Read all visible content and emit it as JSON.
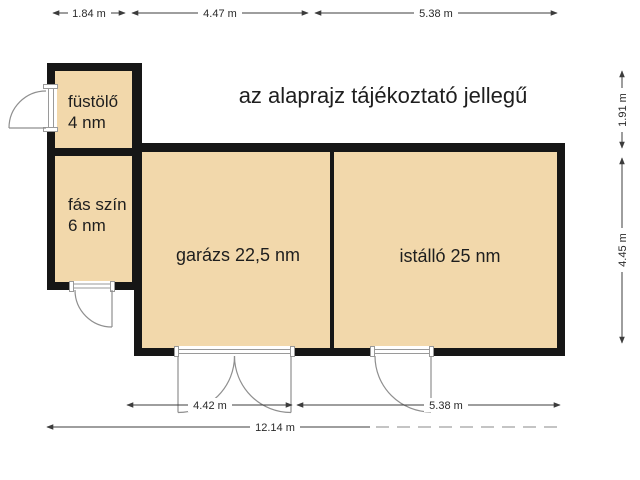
{
  "title": "az alaprajz tájékoztató jellegű",
  "rooms": {
    "fustolo": {
      "line1": "füstölő",
      "line2": "4 nm"
    },
    "fas_szin": {
      "line1": "fás szín",
      "line2": "6 nm"
    },
    "garazs": {
      "label": "garázs 22,5 nm"
    },
    "istallo": {
      "label": "istálló 25 nm"
    }
  },
  "dimensions": {
    "top_left": "1.84 m",
    "top_middle": "4.47 m",
    "top_right": "5.38 m",
    "right_upper": "1.91 m",
    "right_lower": "4.45 m",
    "bottom_garage": "4.42 m",
    "bottom_stable": "5.38 m",
    "bottom_total": "12.14 m"
  },
  "colors": {
    "room_fill": "#f2d8ab",
    "wall": "#161616",
    "dimension": "#3c3c3c",
    "door": "#8f8f8f",
    "text": "#1e1e1e"
  }
}
